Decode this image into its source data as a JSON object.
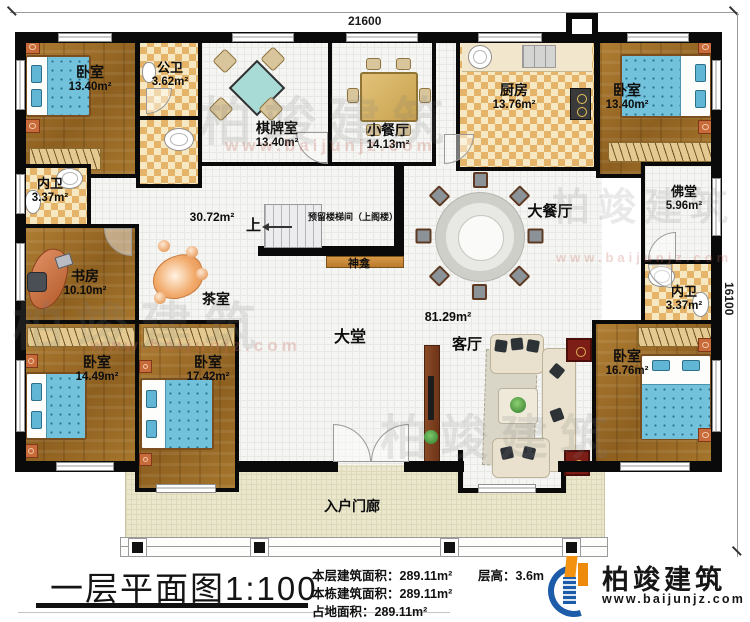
{
  "dimensions": {
    "top": "21600",
    "right": "16100"
  },
  "rooms": {
    "bedroom_tl": {
      "label": "卧室",
      "area": "13.40m²"
    },
    "public_bath": {
      "label": "公卫",
      "area": "3.62m²"
    },
    "mahjong": {
      "label": "棋牌室",
      "area": "13.40m²"
    },
    "small_dining": {
      "label": "小餐厅",
      "area": "14.13m²"
    },
    "kitchen": {
      "label": "厨房",
      "area": "13.76m²"
    },
    "bedroom_tr": {
      "label": "卧室",
      "area": "13.40m²"
    },
    "bath_left": {
      "label": "内卫",
      "area": "3.37m²"
    },
    "study": {
      "label": "书房",
      "area": "10.10m²"
    },
    "tea_room": {
      "label": "茶室"
    },
    "grand_dining": {
      "label": "大餐厅"
    },
    "buddha_hall": {
      "label": "佛堂",
      "area": "5.96m²"
    },
    "bath_right": {
      "label": "内卫",
      "area": "3.37m²"
    },
    "bedroom_bl1": {
      "label": "卧室",
      "area": "14.49m²"
    },
    "bedroom_bl2": {
      "label": "卧室",
      "area": "17.42m²"
    },
    "lobby": {
      "label": "大堂"
    },
    "living": {
      "label": "客厅"
    },
    "bedroom_br": {
      "label": "卧室",
      "area": "16.76m²"
    },
    "porch": {
      "label": "入户门廊"
    }
  },
  "hall_area": "30.72m²",
  "living_area": "81.29m²",
  "stair": {
    "note": "预留楼梯间（上阁楼）",
    "up": "上"
  },
  "shrine": "神龛",
  "footer": {
    "title": "一层平面图1:100",
    "stats": [
      {
        "label": "本层建筑面积：",
        "value": "289.11m²"
      },
      {
        "label": "本栋建筑面积：",
        "value": "289.11m²"
      },
      {
        "label": "占地面积：",
        "value": "289.11m²"
      }
    ],
    "floor_height": {
      "label": "层高：",
      "value": "3.6m"
    },
    "brand": "柏竣建筑",
    "brand_url": "www.baijunjz.com"
  },
  "watermark": {
    "text": "柏竣建筑",
    "url": "www.baijunjz.com"
  }
}
